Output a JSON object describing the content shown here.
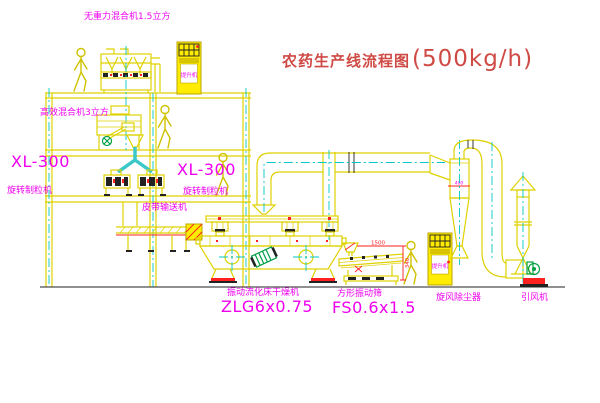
{
  "diagram": {
    "title_zh": "农药生产线流程图",
    "title_capacity": "(500kg/h)",
    "labels": {
      "top_mixer": "无重力混合机1.5立方",
      "second_mixer": "高效混合机3立方",
      "granulator_left_model": "XL-300",
      "granulator_left_name": "旋转制粒机",
      "granulator_mid_model": "XL-300",
      "granulator_mid_name": "旋转制粒机",
      "belt_conveyor": "皮带输送机",
      "dryer_name": "振动流化床干燥机",
      "dryer_model": "ZLG6x0.75",
      "screen_name": "方形振动筛",
      "screen_model": "FS0.6x1.5",
      "cyclone": "旋风除尘器",
      "fan": "引风机",
      "elevator_top": "提升机",
      "elevator_right": "提升机"
    },
    "dimensions": {
      "cyclone_note": "400",
      "screen_width": "1500",
      "screen_height": "340"
    },
    "colors": {
      "line_yellow": "#dfd100",
      "centerline_cyan": "#00c8c8",
      "label_magenta": "#ee00ee",
      "title_red": "#cf4a45",
      "accent_red": "#ff2020",
      "machine_green": "#00a046",
      "detail_black": "#222222",
      "background": "#ffffff"
    }
  }
}
